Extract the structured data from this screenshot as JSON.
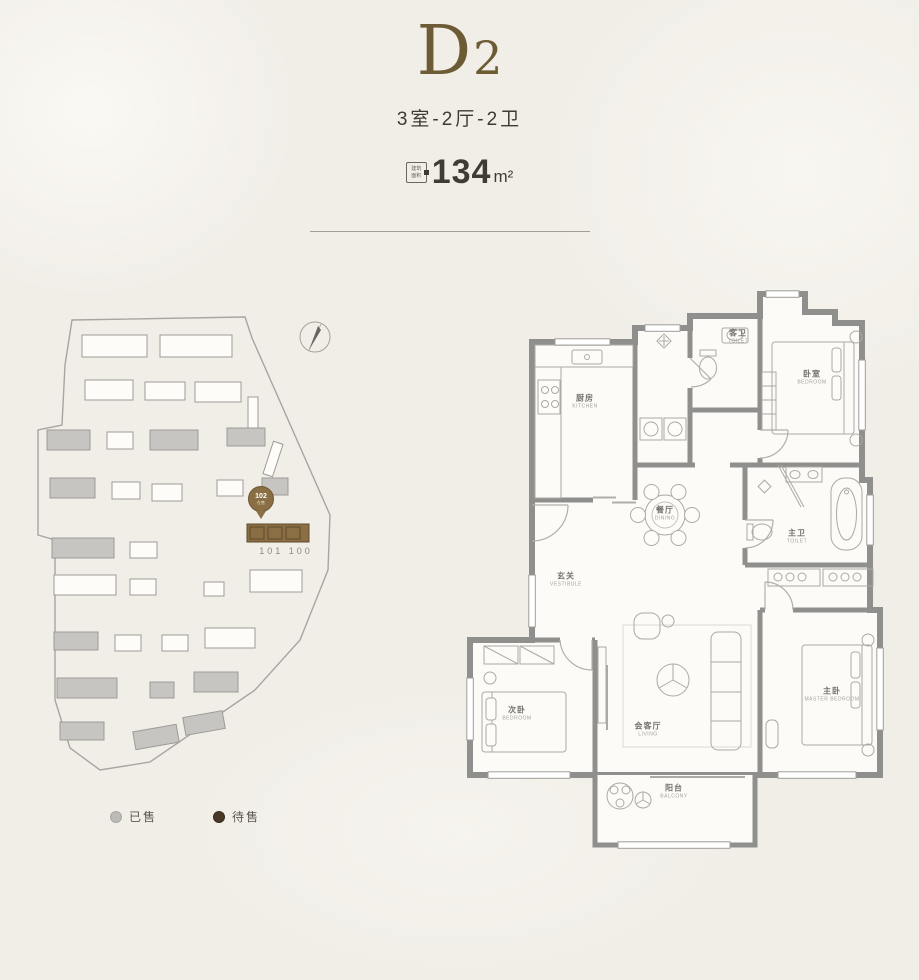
{
  "header": {
    "title_main": "D",
    "title_sub": "2",
    "subtitle": "3室-2厅-2卫",
    "area_badge_top": "建筑",
    "area_badge_bottom": "面积",
    "area_value": "134",
    "area_unit": "m²",
    "accent_color": "#6d5b35"
  },
  "site_plan": {
    "marker_number": "102",
    "marker_sub": "在售",
    "unit_numbers": "101 100",
    "legend_sold": "已售",
    "legend_forsale": "待售",
    "colors": {
      "sold": "#bdbbb7",
      "forsale": "#4a3827",
      "highlight_building": "#8a6e44"
    }
  },
  "floor_plan": {
    "rooms": [
      {
        "zh": "厨房",
        "en": "KITCHEN"
      },
      {
        "zh": "客卫",
        "en": "TOILET"
      },
      {
        "zh": "卧室",
        "en": "BEDROOM"
      },
      {
        "zh": "餐厅",
        "en": "DINING"
      },
      {
        "zh": "主卫",
        "en": "TOILET"
      },
      {
        "zh": "玄关",
        "en": "VESTIBULE"
      },
      {
        "zh": "次卧",
        "en": "BEDROOM"
      },
      {
        "zh": "会客厅",
        "en": "LIVING"
      },
      {
        "zh": "主卧",
        "en": "MASTER BEDROOM"
      },
      {
        "zh": "阳台",
        "en": "BALCONY"
      }
    ]
  }
}
